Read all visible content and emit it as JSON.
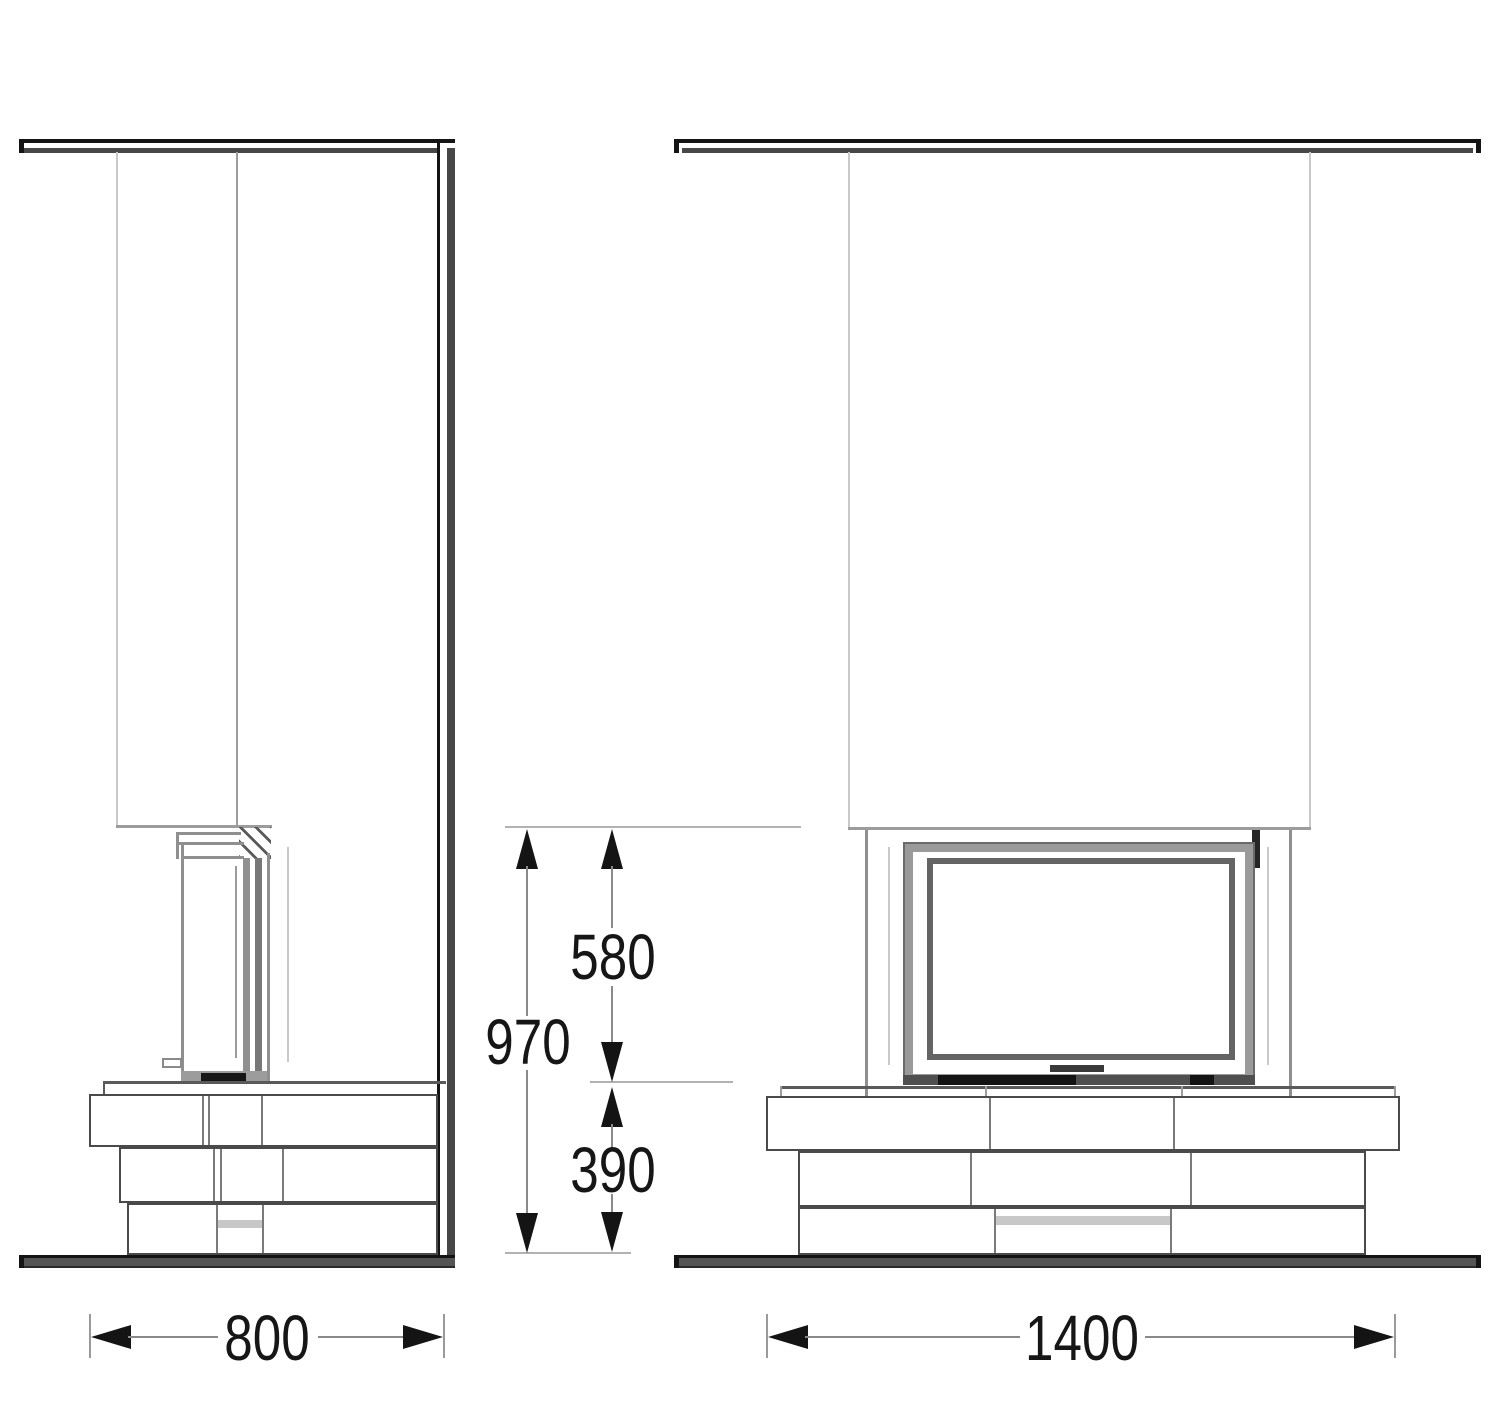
{
  "annotations": {
    "height_total": "970",
    "height_opening": "580",
    "height_base": "390",
    "depth_side": "800",
    "width_front": "1400"
  },
  "palette": {
    "background": "#ffffff",
    "structure_black": "#141414",
    "structure_gray": "#474747",
    "line_mid": "#8f8f8f",
    "line_light": "#c9c9c9",
    "dimension_text": "#161616"
  }
}
